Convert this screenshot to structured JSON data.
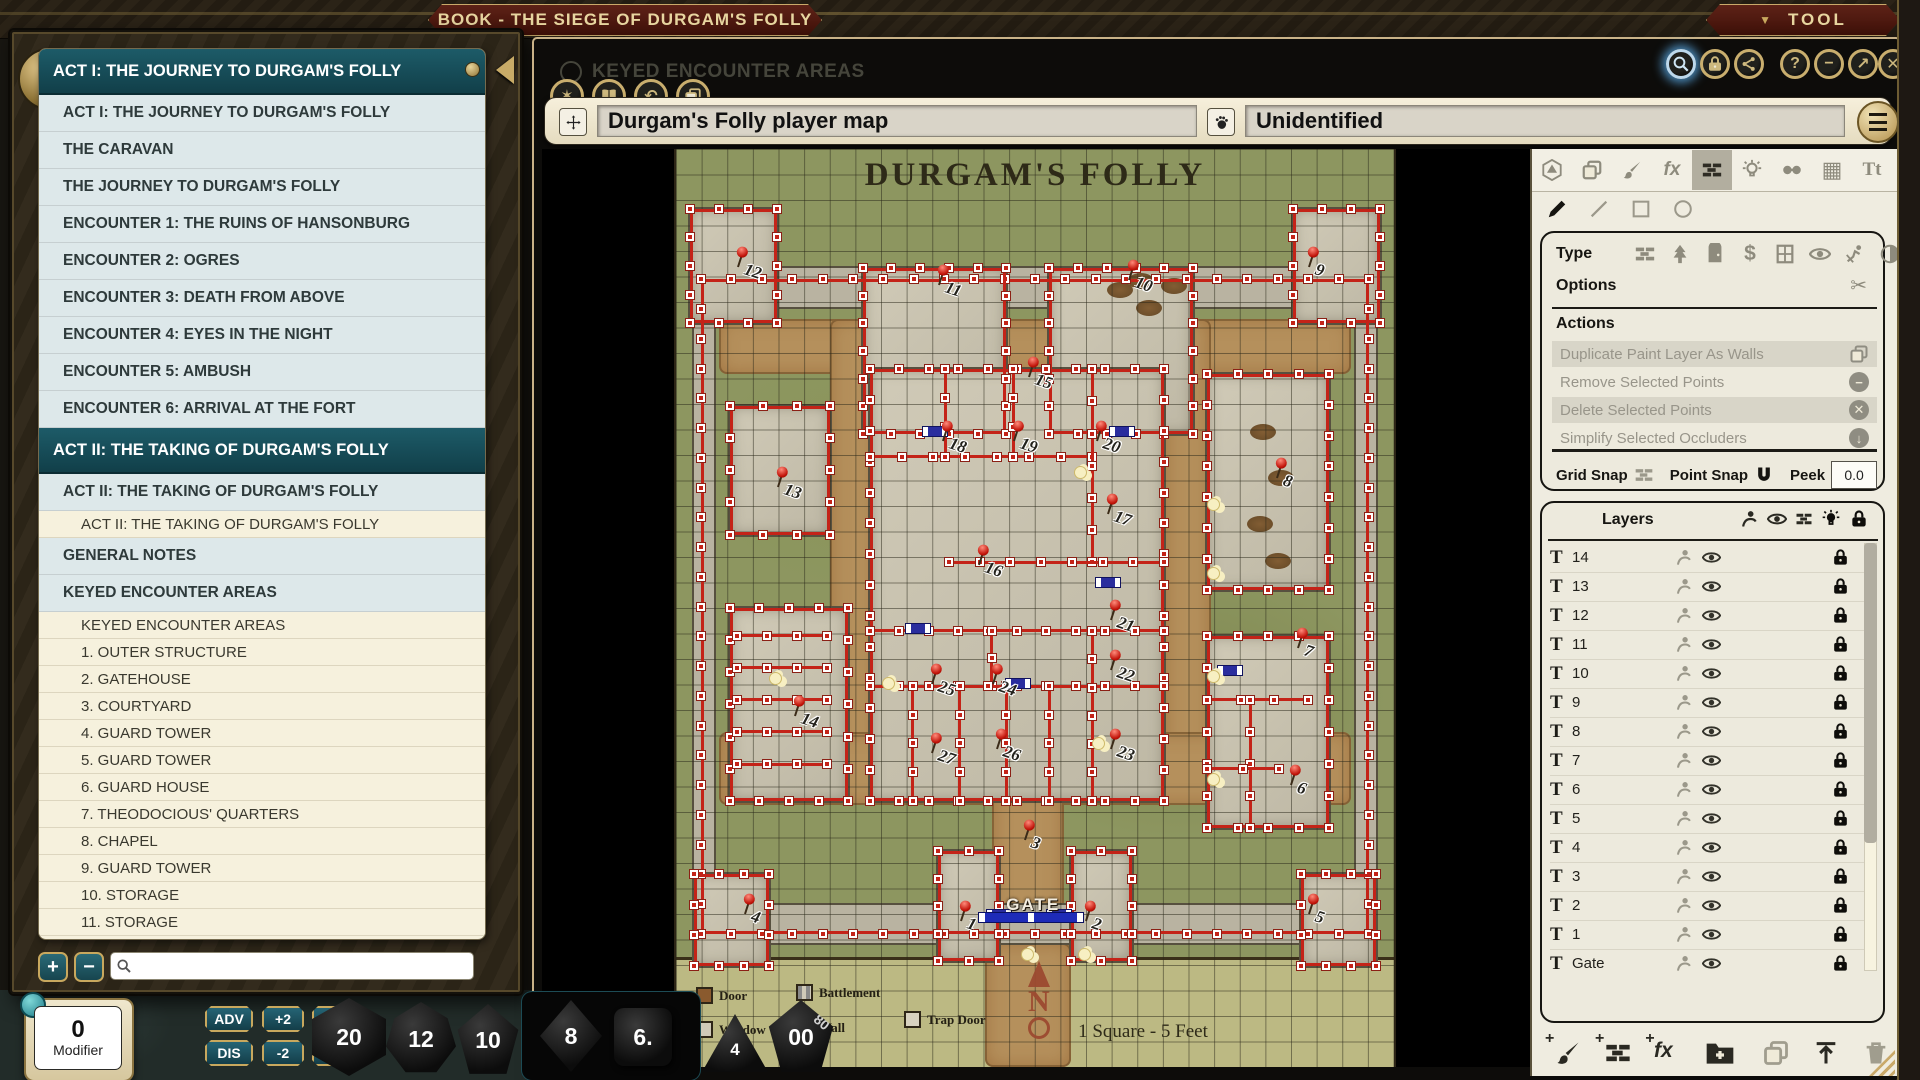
{
  "desktop": {
    "tool_menu_label": "TOOL"
  },
  "background_window": {
    "heading": "KEYED ENCOUNTER AREAS"
  },
  "book_window": {
    "title": "BOOK - THE SIEGE OF DURGAM'S FOLLY",
    "toc": [
      {
        "t": "h",
        "label": "ACT I: THE JOURNEY TO DURGAM'S FOLLY"
      },
      {
        "t": "a",
        "label": "ACT I: THE JOURNEY TO DURGAM'S FOLLY"
      },
      {
        "t": "a",
        "label": "THE CARAVAN"
      },
      {
        "t": "a",
        "label": "THE JOURNEY TO DURGAM'S FOLLY"
      },
      {
        "t": "a",
        "label": "ENCOUNTER 1: THE RUINS OF HANSONBURG"
      },
      {
        "t": "a",
        "label": "ENCOUNTER 2: OGRES"
      },
      {
        "t": "a",
        "label": "ENCOUNTER 3: DEATH FROM ABOVE"
      },
      {
        "t": "a",
        "label": "ENCOUNTER 4: EYES IN THE NIGHT"
      },
      {
        "t": "a",
        "label": "ENCOUNTER 5: AMBUSH"
      },
      {
        "t": "a",
        "label": "ENCOUNTER 6: ARRIVAL AT THE FORT"
      },
      {
        "t": "h",
        "label": "ACT II: THE TAKING OF DURGAM'S FOLLY"
      },
      {
        "t": "a",
        "label": "ACT II: THE TAKING OF DURGAM'S FOLLY"
      },
      {
        "t": "s",
        "label": "ACT II: THE TAKING OF DURGAM'S FOLLY"
      },
      {
        "t": "a",
        "label": "GENERAL NOTES"
      },
      {
        "t": "a",
        "label": "KEYED ENCOUNTER AREAS"
      },
      {
        "t": "s",
        "label": "KEYED ENCOUNTER AREAS"
      },
      {
        "t": "s",
        "label": "1. OUTER STRUCTURE"
      },
      {
        "t": "s",
        "label": "2. GATEHOUSE"
      },
      {
        "t": "s",
        "label": "3. COURTYARD"
      },
      {
        "t": "s",
        "label": "4. GUARD TOWER"
      },
      {
        "t": "s",
        "label": "5. GUARD TOWER"
      },
      {
        "t": "s",
        "label": "6. GUARD HOUSE"
      },
      {
        "t": "s",
        "label": "7. THEODOCIOUS' QUARTERS"
      },
      {
        "t": "s",
        "label": "8. CHAPEL"
      },
      {
        "t": "s",
        "label": "9. GUARD TOWER"
      },
      {
        "t": "s",
        "label": "10. STORAGE"
      },
      {
        "t": "s",
        "label": "11. STORAGE"
      }
    ]
  },
  "map_window": {
    "name_value": "Durgam's Folly player map",
    "share_value": "Unidentified",
    "map": {
      "title": "DURGAM'S FOLLY",
      "gate_label": "GATE",
      "scale_label": "1 Square - 5 Feet",
      "compass_letter": "N",
      "legend": [
        "Door",
        "Battlement",
        "Window",
        "Wall",
        "Trap Door"
      ],
      "pins": [
        {
          "n": "1",
          "x": 39.5,
          "y": 82.8
        },
        {
          "n": "2",
          "x": 57,
          "y": 82.8
        },
        {
          "n": "3",
          "x": 48.5,
          "y": 74
        },
        {
          "n": "4",
          "x": 9.5,
          "y": 82
        },
        {
          "n": "5",
          "x": 88,
          "y": 82
        },
        {
          "n": "6",
          "x": 85.5,
          "y": 68
        },
        {
          "n": "7",
          "x": 86.5,
          "y": 53
        },
        {
          "n": "8",
          "x": 83.5,
          "y": 34.5
        },
        {
          "n": "9",
          "x": 88,
          "y": 11.5
        },
        {
          "n": "10",
          "x": 63,
          "y": 13
        },
        {
          "n": "11",
          "x": 36.5,
          "y": 13.5
        },
        {
          "n": "12",
          "x": 8.5,
          "y": 11.5
        },
        {
          "n": "13",
          "x": 14,
          "y": 35.5
        },
        {
          "n": "14",
          "x": 16.5,
          "y": 60.5
        },
        {
          "n": "15",
          "x": 49,
          "y": 23.5
        },
        {
          "n": "16",
          "x": 42,
          "y": 44
        },
        {
          "n": "17",
          "x": 60,
          "y": 38.5
        },
        {
          "n": "18",
          "x": 37,
          "y": 30.5
        },
        {
          "n": "19",
          "x": 47,
          "y": 30.5
        },
        {
          "n": "20",
          "x": 58.5,
          "y": 30.5
        },
        {
          "n": "21",
          "x": 60.5,
          "y": 50
        },
        {
          "n": "22",
          "x": 60.5,
          "y": 55.5
        },
        {
          "n": "23",
          "x": 60.5,
          "y": 64
        },
        {
          "n": "24",
          "x": 44,
          "y": 57
        },
        {
          "n": "25",
          "x": 35.5,
          "y": 57
        },
        {
          "n": "26",
          "x": 44.5,
          "y": 64
        },
        {
          "n": "27",
          "x": 35.5,
          "y": 64.5
        }
      ],
      "buildings": [
        [
          2,
          6.5,
          12,
          12.5
        ],
        [
          86,
          6.5,
          12,
          12.5
        ],
        [
          2.5,
          79,
          10.5,
          10
        ],
        [
          87,
          79,
          10.5,
          10
        ],
        [
          26,
          13,
          20,
          18
        ],
        [
          52,
          13,
          20,
          18
        ],
        [
          7.5,
          28,
          14,
          14
        ],
        [
          27,
          24,
          41,
          47
        ],
        [
          7.5,
          50,
          16.5,
          21
        ],
        [
          74,
          24.5,
          17,
          23.5
        ],
        [
          74,
          53,
          17,
          21
        ],
        [
          36.5,
          76.5,
          8.5,
          12
        ],
        [
          55,
          76.5,
          8.5,
          12
        ]
      ],
      "wall_bands": [
        [
          2.5,
          13,
          95,
          4.2
        ],
        [
          2.5,
          82.3,
          95,
          4.2
        ],
        [
          2.5,
          13,
          2.8,
          73.5
        ],
        [
          94.7,
          13,
          2.8,
          73.5
        ]
      ],
      "wall_ring": [
        3.5,
        14.2,
        93,
        71.3
      ],
      "inner_lines": [
        [
          27,
          33.5,
          58,
          33.5
        ],
        [
          37.5,
          24,
          37.5,
          33.5
        ],
        [
          47,
          24,
          47,
          33.5
        ],
        [
          58,
          24,
          58,
          45
        ],
        [
          38,
          45,
          68,
          45
        ],
        [
          27,
          52.5,
          68,
          52.5
        ],
        [
          44,
          52.5,
          44,
          58.5
        ],
        [
          27,
          58.5,
          68,
          58.5
        ],
        [
          33,
          58.5,
          33,
          71
        ],
        [
          39.5,
          58.5,
          39.5,
          71
        ],
        [
          46,
          58.5,
          46,
          71
        ],
        [
          52,
          58.5,
          52,
          71
        ],
        [
          58,
          52.5,
          58,
          71
        ],
        [
          8.5,
          53,
          21,
          53
        ],
        [
          8.5,
          56.5,
          21,
          56.5
        ],
        [
          8.5,
          60,
          21,
          60
        ],
        [
          8.5,
          63.5,
          21,
          63.5
        ],
        [
          8.5,
          67,
          21,
          67
        ],
        [
          74,
          60,
          88,
          60
        ],
        [
          80,
          60,
          80,
          74
        ],
        [
          74,
          67.5,
          84,
          67.5
        ]
      ],
      "roads": [
        [
          6,
          18.5,
          88,
          6
        ],
        [
          21.5,
          18.5,
          6.5,
          53
        ],
        [
          68,
          18.5,
          6.5,
          53
        ],
        [
          6,
          63.5,
          88,
          8
        ],
        [
          44,
          70,
          10,
          17
        ],
        [
          43,
          86.5,
          12,
          13.5
        ]
      ],
      "doors": [
        [
          36,
          30.6
        ],
        [
          62,
          30.6
        ],
        [
          33.5,
          52.1
        ],
        [
          47.5,
          58.1
        ],
        [
          77,
          56.6
        ],
        [
          60,
          47.1
        ],
        [
          44.8,
          83.2
        ],
        [
          53.2,
          83.2
        ]
      ],
      "lights": [
        [
          55.5,
          34.5
        ],
        [
          74,
          38
        ],
        [
          74,
          45.5
        ],
        [
          74,
          56.8
        ],
        [
          28.7,
          57.5
        ],
        [
          13,
          57
        ],
        [
          48,
          87
        ],
        [
          56,
          87
        ],
        [
          74,
          68
        ],
        [
          58,
          64
        ]
      ],
      "debris": [
        [
          60,
          14.5
        ],
        [
          64,
          16.5
        ],
        [
          67.5,
          14
        ],
        [
          80,
          30
        ],
        [
          82.5,
          35
        ],
        [
          79.5,
          40
        ],
        [
          82,
          44
        ],
        [
          63,
          13.5
        ]
      ],
      "gate_bar": {
        "x": 42,
        "y": 83.1,
        "w": 14.5
      }
    },
    "tool_panel": {
      "type_label": "Type",
      "options_label": "Options",
      "actions_label": "Actions",
      "actions": [
        {
          "label": "Duplicate Paint Layer As Walls",
          "icon": "copy",
          "highlighted": true
        },
        {
          "label": "Remove Selected Points",
          "icon": "minus",
          "highlighted": false
        },
        {
          "label": "Delete Selected Points",
          "icon": "x",
          "highlighted": true
        },
        {
          "label": "Simplify Selected Occluders",
          "icon": "down",
          "highlighted": false
        }
      ],
      "grid_snap_label": "Grid Snap",
      "point_snap_label": "Point Snap",
      "peek_label": "Peek",
      "peek_value": "0.0",
      "layers_title": "Layers",
      "layers": [
        {
          "kind": "text",
          "label": "14"
        },
        {
          "kind": "text",
          "label": "13"
        },
        {
          "kind": "text",
          "label": "12"
        },
        {
          "kind": "text",
          "label": "11"
        },
        {
          "kind": "text",
          "label": "10"
        },
        {
          "kind": "text",
          "label": "9"
        },
        {
          "kind": "text",
          "label": "8"
        },
        {
          "kind": "text",
          "label": "7"
        },
        {
          "kind": "text",
          "label": "6"
        },
        {
          "kind": "text",
          "label": "5"
        },
        {
          "kind": "text",
          "label": "4"
        },
        {
          "kind": "text",
          "label": "3"
        },
        {
          "kind": "text",
          "label": "2"
        },
        {
          "kind": "text",
          "label": "1"
        },
        {
          "kind": "text",
          "label": "Gate"
        },
        {
          "kind": "image",
          "label": "Durgam's Folly play..."
        }
      ]
    }
  },
  "hotbar": {
    "modifier_value": "0",
    "modifier_label": "Modifier",
    "adv": "ADV",
    "dis": "DIS",
    "plus2": "+2",
    "minus2": "-2",
    "plus5": "+5",
    "minus5": "-5",
    "dice": [
      {
        "name": "d20",
        "label": "20"
      },
      {
        "name": "d12",
        "label": "12"
      },
      {
        "name": "d10",
        "label": "10"
      },
      {
        "name": "d8",
        "label": "8"
      },
      {
        "name": "d6",
        "label": "6."
      },
      {
        "name": "d4",
        "label": "4"
      },
      {
        "name": "d100",
        "label": "00",
        "side": "80"
      }
    ]
  }
}
